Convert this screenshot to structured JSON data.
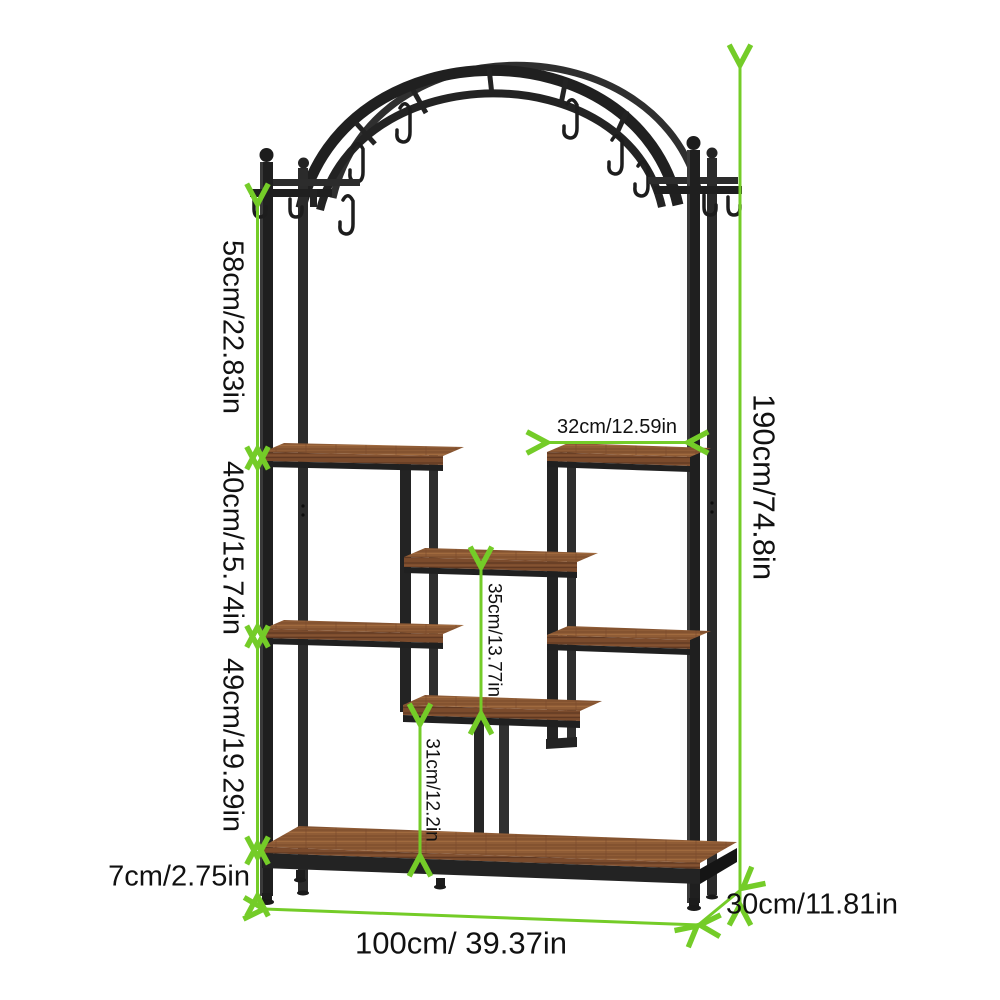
{
  "illustration": {
    "subject": "arched-plant-stand-with-hanging-hooks",
    "colors": {
      "metal_frame": "#1f1f1f",
      "wood_top": "#8f5c36",
      "wood_front": "#7b4b2c",
      "dimension_accent": "#74cc28",
      "label_text": "#111111",
      "background": "#ffffff"
    }
  },
  "dimensions": {
    "d58": {
      "label": "58cm/22.83in"
    },
    "d40": {
      "label": "40cm/15.74in"
    },
    "d49": {
      "label": "49cm/19.29in"
    },
    "d7": {
      "label": "7cm/2.75in"
    },
    "d190": {
      "label": "190cm/74.8in"
    },
    "d32": {
      "label": "32cm/12.59in"
    },
    "d35": {
      "label": "35cm/13.77in"
    },
    "d31": {
      "label": "31cm/12.2in"
    },
    "d100": {
      "label": "100cm/ 39.37in"
    },
    "d30": {
      "label": "30cm/11.81in"
    }
  }
}
